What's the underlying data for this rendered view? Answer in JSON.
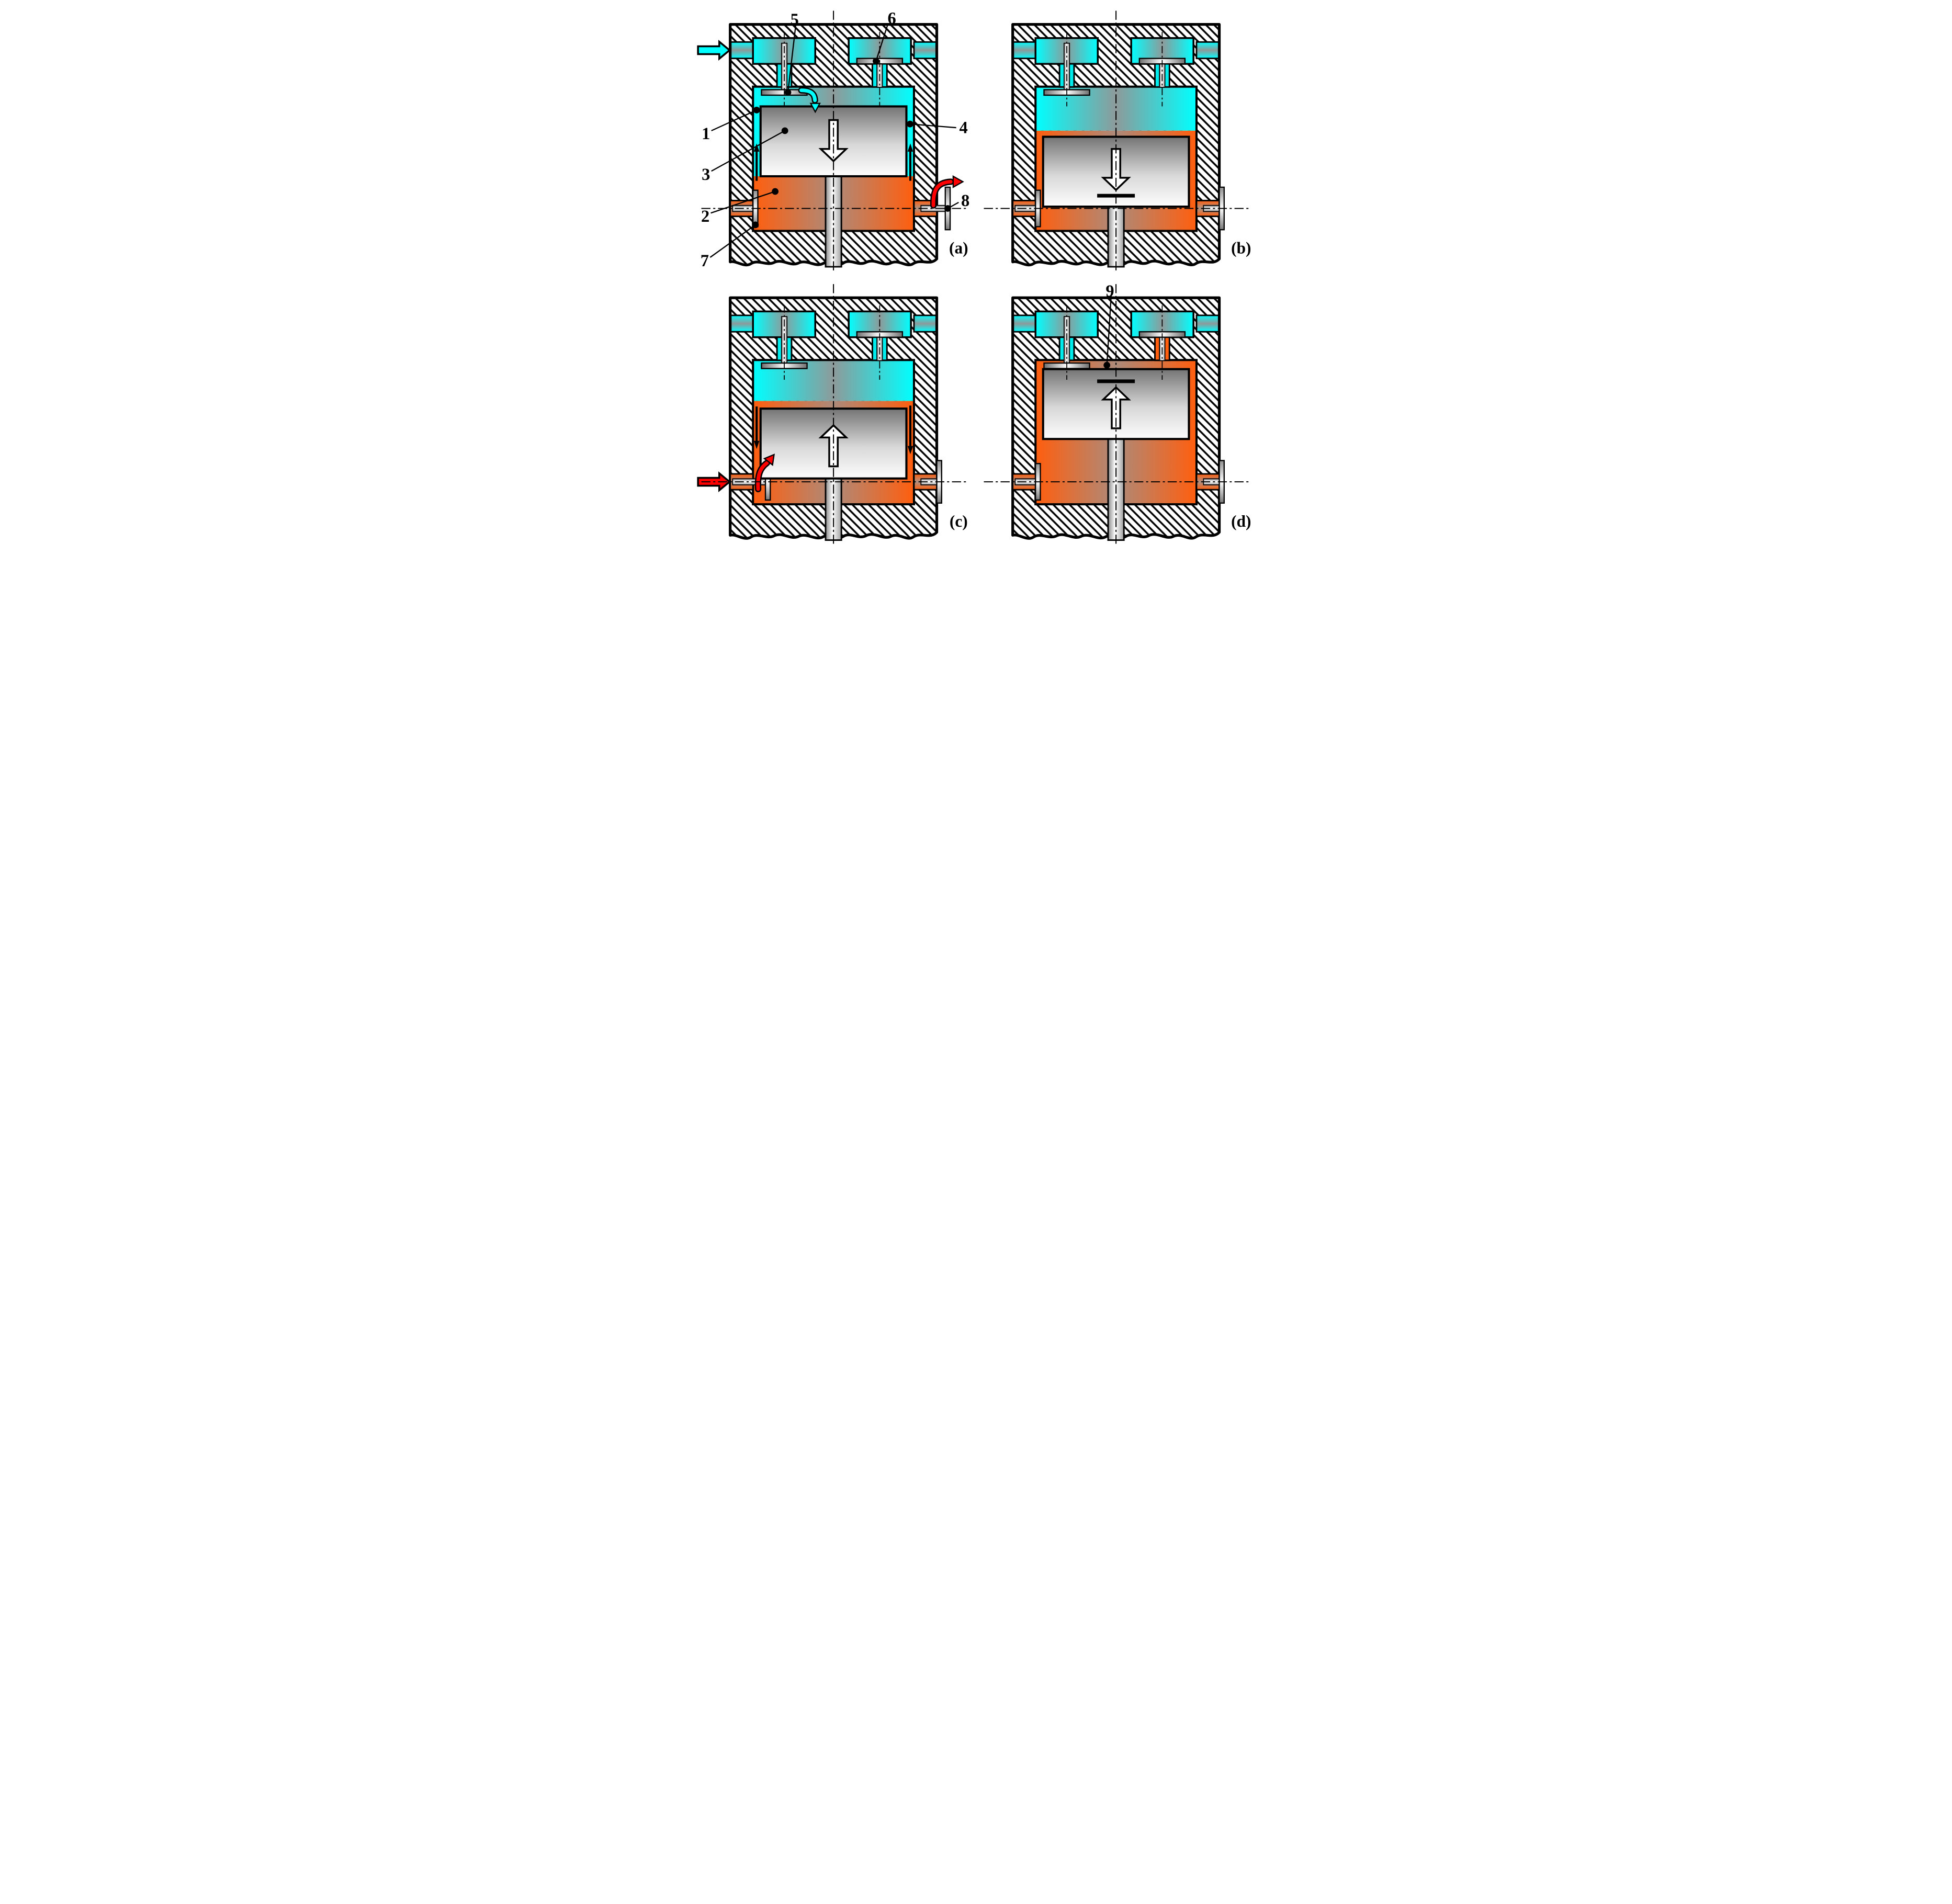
{
  "diagram": {
    "kind": "piston-cylinder working-cycle cross-section, four phases",
    "colors": {
      "cold_gas": "#00FFFF",
      "hot_gas": "#FF5E0E",
      "flow_hot_red": "#FF0000",
      "outline": "#000000",
      "metal_mid": "#8A8A8A",
      "metal_light": "#FFFFFF"
    },
    "panels": [
      {
        "letter": "(a)",
        "piston_motion": "down",
        "stop_bar": false,
        "regions": {
          "upper": "cold",
          "annulus": "cold",
          "lower": "hot"
        },
        "valves": {
          "left": "open",
          "right": "closed"
        },
        "right_valve_bore_gas": "cold",
        "side_ports": {
          "left": "closed",
          "right": "open"
        },
        "external_flow": {
          "location": "head-inlet-left",
          "gas": "cold"
        },
        "annulus_flow": "up",
        "flow_curls": [
          "valve-intake",
          "port-exhaust"
        ],
        "callouts": [
          {
            "text": "5",
            "target": "intake-valve-disc-open"
          },
          {
            "text": "6",
            "target": "head-valve-disc-closed"
          },
          {
            "text": "1",
            "target": "cold-gas-annulus-left"
          },
          {
            "text": "3",
            "target": "piston"
          },
          {
            "text": "4",
            "target": "cold-gas-annulus-right"
          },
          {
            "text": "2",
            "target": "hot-gas-lower-chamber"
          },
          {
            "text": "7",
            "target": "left-port-check-disc"
          },
          {
            "text": "8",
            "target": "right-port-check-disc-open"
          }
        ]
      },
      {
        "letter": "(b)",
        "piston_motion": "down",
        "stop_bar": true,
        "regions": {
          "upper": "cold",
          "annulus": "hot",
          "lower": "hot"
        },
        "valves": {
          "left": "open",
          "right": "closed"
        },
        "right_valve_bore_gas": "cold",
        "side_ports": {
          "left": "closed",
          "right": "closed"
        },
        "external_flow": null,
        "annulus_flow": null,
        "flow_curls": [],
        "callouts": []
      },
      {
        "letter": "(c)",
        "piston_motion": "up",
        "stop_bar": false,
        "regions": {
          "upper": "cold",
          "annulus": "hot",
          "lower": "hot"
        },
        "valves": {
          "left": "open",
          "right": "closed"
        },
        "right_valve_bore_gas": "cold",
        "side_ports": {
          "left": "open",
          "right": "closed"
        },
        "external_flow": {
          "location": "left-port",
          "gas": "hot"
        },
        "annulus_flow": "down",
        "flow_curls": [
          "port-intake"
        ],
        "callouts": []
      },
      {
        "letter": "(d)",
        "piston_motion": "up",
        "stop_bar": true,
        "regions": {
          "upper": "hot",
          "annulus": "hot",
          "lower": "hot"
        },
        "valves": {
          "left": "open",
          "right": "closed"
        },
        "right_valve_bore_gas": "hot",
        "side_ports": {
          "left": "closed",
          "right": "closed"
        },
        "external_flow": null,
        "annulus_flow": null,
        "flow_curls": [],
        "callouts": [
          {
            "text": "9",
            "target": "residual-hot-gas-layer"
          }
        ]
      }
    ]
  }
}
